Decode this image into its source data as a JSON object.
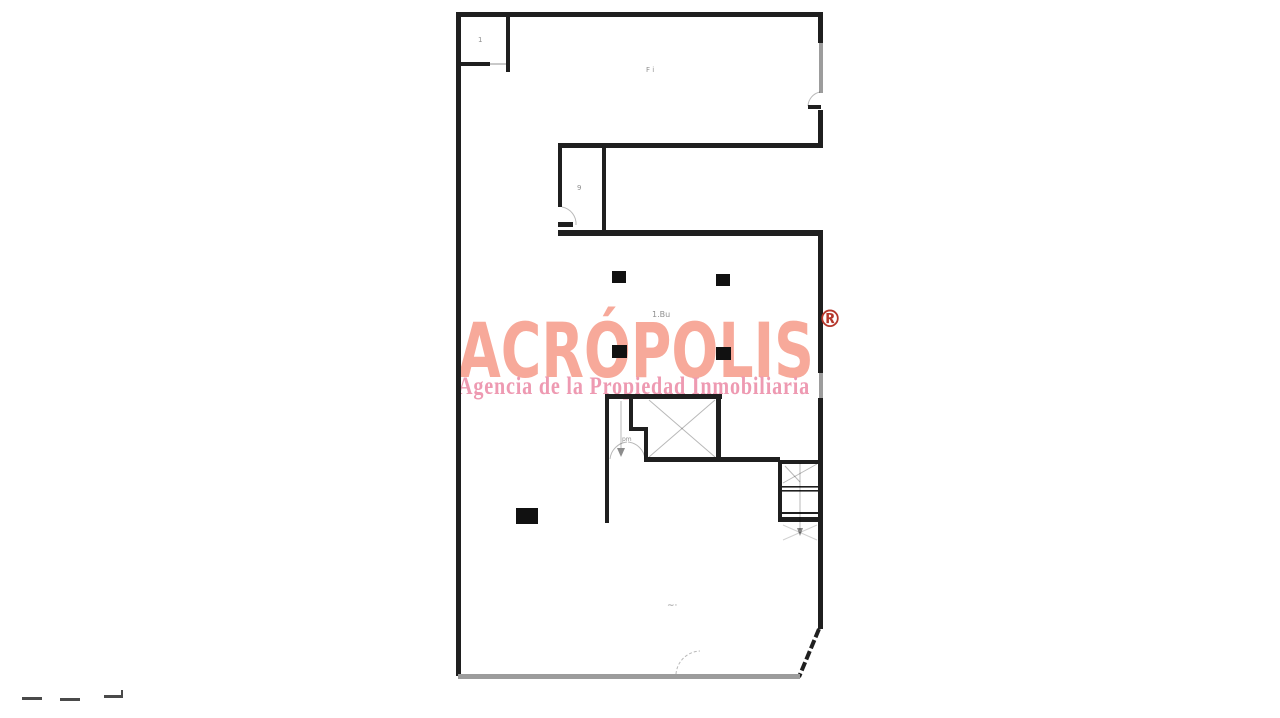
{
  "page": {
    "background": "#ffffff"
  },
  "watermark": {
    "brand": "ACRÓPOLIS",
    "registered": "®",
    "tagline": "Agencia de la Propiedad Inmobiliaria",
    "brand_color": "#f7a99a",
    "tagline_color": "#ee9ab2",
    "registered_color": "#b5362b"
  },
  "plan": {
    "type": "architectural-floor-plan",
    "wall_color": "#1f1f1f",
    "window_color": "#9c9c9c",
    "faint_color": "#8f8f8f",
    "labels": {
      "top_left_room": "1",
      "upper_hall": "F i",
      "small_room": "9",
      "center_note": "1.Bu",
      "stair_note": "pm",
      "lower_note": "~·"
    }
  }
}
